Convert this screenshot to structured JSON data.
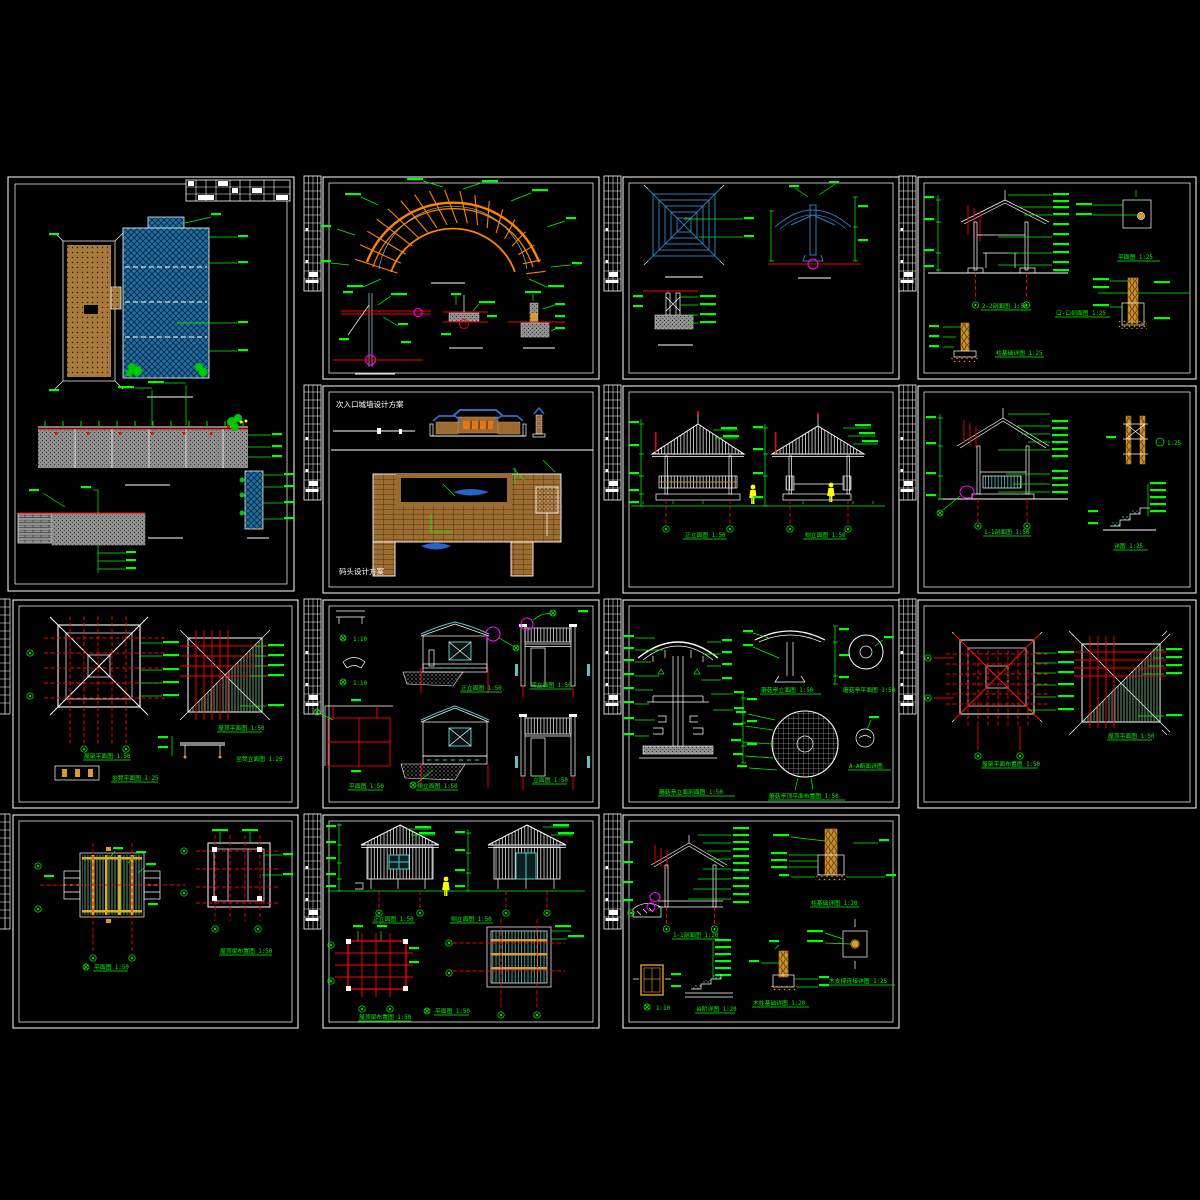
{
  "app": {
    "background": "#000000",
    "description_colors": {
      "annotation_green": "#00ff00",
      "dimension_red": "#ff0000",
      "pergola_orange": "#ff8400",
      "wood_brown": "#a87a3c",
      "water_blue": "#1f6ea6",
      "roof_blue": "#2a7db4",
      "teal_cyan": "#58c4c4",
      "pale_green_hatch": "#8fd8a8",
      "magenta": "#ff00ff",
      "figure_yellow": "#ffff00",
      "post_orange": "#e09a28",
      "line_white": "#ffffff",
      "concrete_gray": "#8e8e8e"
    }
  },
  "sheets": [
    {
      "id": "01",
      "titles": {}
    },
    {
      "id": "02",
      "titles": {}
    },
    {
      "id": "03",
      "titles": {}
    },
    {
      "id": "04",
      "titles": {
        "t1": "2-2剖面图 1:50",
        "t2": "口-口剖面图 1:25",
        "t3": "柱基础详图 1:25",
        "t4": "平面图 1:25"
      }
    },
    {
      "id": "05",
      "titles": {
        "top": "次入口城墙设计方案",
        "bottom": "码头设计方案"
      }
    },
    {
      "id": "06",
      "titles": {
        "t1": "正立面图 1:50",
        "t2": "侧立面图 1:50"
      }
    },
    {
      "id": "07",
      "titles": {
        "t1": "1-1剖面图 1:50",
        "t2": "详图 1:25",
        "s1": "1:25"
      }
    },
    {
      "id": "08",
      "titles": {
        "t1": "屋架平面图 1:50",
        "t2": "屋顶平面图 1:50",
        "t3": "坐凳立面图 1:25",
        "t4": "坐凳平面图 1:25"
      }
    },
    {
      "id": "09",
      "titles": {
        "s1": "1:10",
        "s2": "1:10",
        "t1": "正立面图 1:50",
        "t2": "背立面图 1:50",
        "t3": "侧立面图 1:50",
        "t4": "立面图 1:50",
        "t5": "平面图 1:50"
      }
    },
    {
      "id": "10",
      "titles": {
        "t1": "蘑菇亭立面剖面图 1:50",
        "t2": "蘑菇亭立面图 1:50",
        "t3": "蘑菇亭平面图 1:50",
        "t4": "蘑菇亭顶平面布置图 1:50",
        "t5": "A-A断面详图"
      }
    },
    {
      "id": "11",
      "titles": {
        "t1": "屋架平面布置图 1:50",
        "t2": "屋顶平面图 1:50"
      }
    },
    {
      "id": "12",
      "titles": {
        "t1": "平面图 1:50",
        "t2": "屋顶梁布置图 1:50"
      }
    },
    {
      "id": "13",
      "titles": {
        "t1": "正立面图 1:50",
        "t2": "侧立面图 1:50",
        "t3": "屋顶梁布置图 1:50",
        "t4": "平面图 1:50"
      }
    },
    {
      "id": "14",
      "titles": {
        "t1": "1-1剖面图 1:20",
        "t2": "柱基础详图 1:20",
        "t3": "台阶详图 1:20",
        "t4": "木柱基础详图 1:20",
        "t5": "木支撑连接详图 1:25",
        "s1": "1:10"
      }
    }
  ]
}
